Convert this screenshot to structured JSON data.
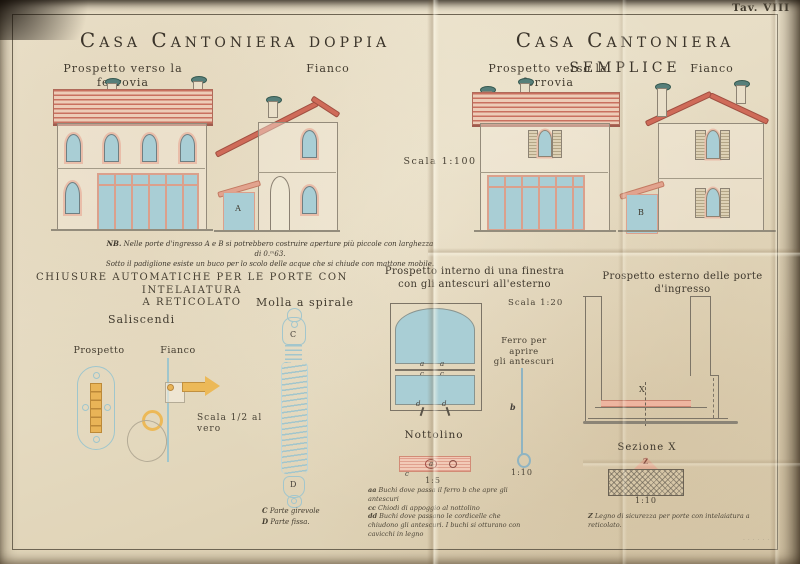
{
  "plate": {
    "tav_label": "Tav. VIII",
    "printer_mark": "· · · · · ·"
  },
  "doppia": {
    "title": "Casa Cantoniera doppia",
    "front_label": "Prospetto verso la ferrovia",
    "side_label": "Fianco",
    "door_letter": "A"
  },
  "semplice": {
    "title": "Casa Cantoniera semplice",
    "front_label": "Prospetto verso la ferrovia",
    "side_label": "Fianco",
    "door_letter": "B"
  },
  "scala_100": "Scala 1:100",
  "nb_note": {
    "prefix": "NB.",
    "line1": " Nelle porte d'ingresso A e B si potrebbero costruire aperture più piccole con larghezza di 0.ᵐ63.",
    "line2": "Sotto il padiglione esiste un buco per lo scolo delle acque che si chiude con mattone mobile."
  },
  "chiusure": {
    "heading_line1": "CHIUSURE AUTOMATICHE PER LE PORTE CON INTELAIATURA",
    "heading_line2": "A RETICOLATO",
    "saliscendi": "Saliscendi",
    "molla": "Molla a spirale",
    "prospetto": "Prospetto",
    "fianco": "Fianco",
    "scala": "Scala 1/2 al vero",
    "letter_c": "C",
    "letter_d": "D",
    "caption_c_prefix": "C",
    "caption_c": "Parte girevole",
    "caption_d_prefix": "D",
    "caption_d": "Parte fissa."
  },
  "finestra": {
    "title_line1": "Prospetto interno di una finestra",
    "title_line2": "con gli antescuri all'esterno",
    "scala": "Scala 1:20",
    "ferro_line1": "Ferro per aprire",
    "ferro_line2": "gli antescuri",
    "letter_a": "a",
    "letter_c": "c",
    "letter_d": "d",
    "letter_b": "b",
    "nottolino": "Nottolino",
    "scala_nottolino": "1:5",
    "scala_ferro": "1:10",
    "legend": [
      {
        "prefix": "aa",
        "text": " Buchi dove passa il ferro b che apre gli antescuri"
      },
      {
        "prefix": "cc",
        "text": " Chiodi di appoggio al nottolino"
      },
      {
        "prefix": "dd",
        "text": " Buchi dove passano le cordicelle che chiudono gli antescuri. I buchi si otturano con cavicchi in legno"
      }
    ]
  },
  "porte": {
    "title": "Prospetto esterno delle porte d'ingresso",
    "letter_x": "X",
    "sezione": "Sezione X",
    "letter_z": "Z",
    "scala": "1:10",
    "caption_prefix": "Z",
    "caption": " Legno di sicurezza per porte con intelaiatura a reticolato."
  }
}
